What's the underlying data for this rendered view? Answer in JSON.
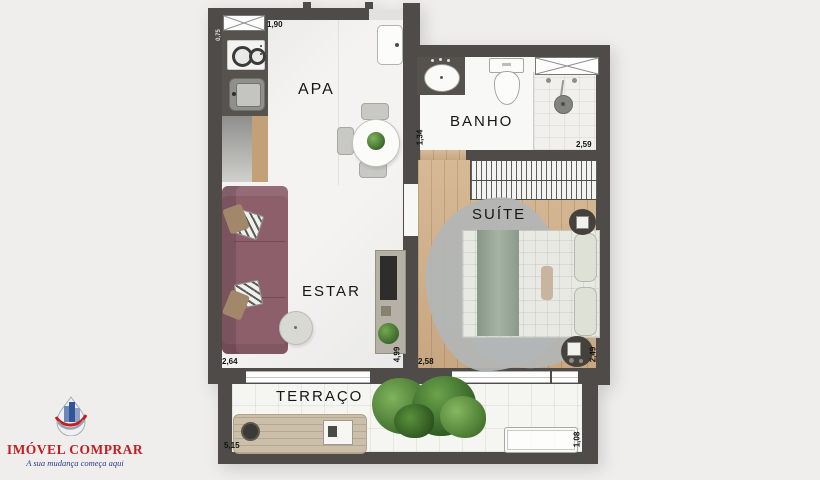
{
  "logo": {
    "brand": "IMÓVEL COMPRAR",
    "tagline": "A sua mudança começa aqui"
  },
  "plan": {
    "rooms": {
      "apa": "APA",
      "banho": "BANHO",
      "suite": "SUÍTE",
      "estar": "ESTAR",
      "terraco": "TERRAÇO"
    },
    "dimensions": {
      "apa_top": "1,90",
      "kitchen_side": "0,75",
      "banho_side": "1,34",
      "banho_bottom": "2,59",
      "suite_bottom": "2,58",
      "suite_side": "2,49",
      "estar_bottom": "2,64",
      "estar_side": "4,99",
      "terraco_bottom": "5,15",
      "terraco_side": "1,08"
    },
    "icons": [
      "stove-icon",
      "kitchen-sink-icon",
      "cabinet-x-icon",
      "basin-icon",
      "toilet-icon",
      "shower-head-icon",
      "towel-niche-icon",
      "wardrobe-icon",
      "bed-icon",
      "nightstand-icon",
      "stool-icon",
      "sofa-icon",
      "side-table-icon",
      "tv-rack-icon",
      "dining-table-icon",
      "entry-door-icon",
      "terrace-table-icon",
      "planter-icon",
      "plant-icon",
      "logo-mark"
    ]
  },
  "colors": {
    "bg": "#efeeec",
    "wall": "#4e4b48",
    "floor-light": "#f4f3f1",
    "floor-wood": "#d2b088",
    "floor-tile": "#f5f5f2",
    "sofa": "#8c5f6b",
    "bed-green": "#9aab99",
    "rug": "#b2b6b7",
    "plant": "#4e7d35",
    "brand-red": "#c41d1f",
    "brand-blue": "#2c3a8a"
  }
}
